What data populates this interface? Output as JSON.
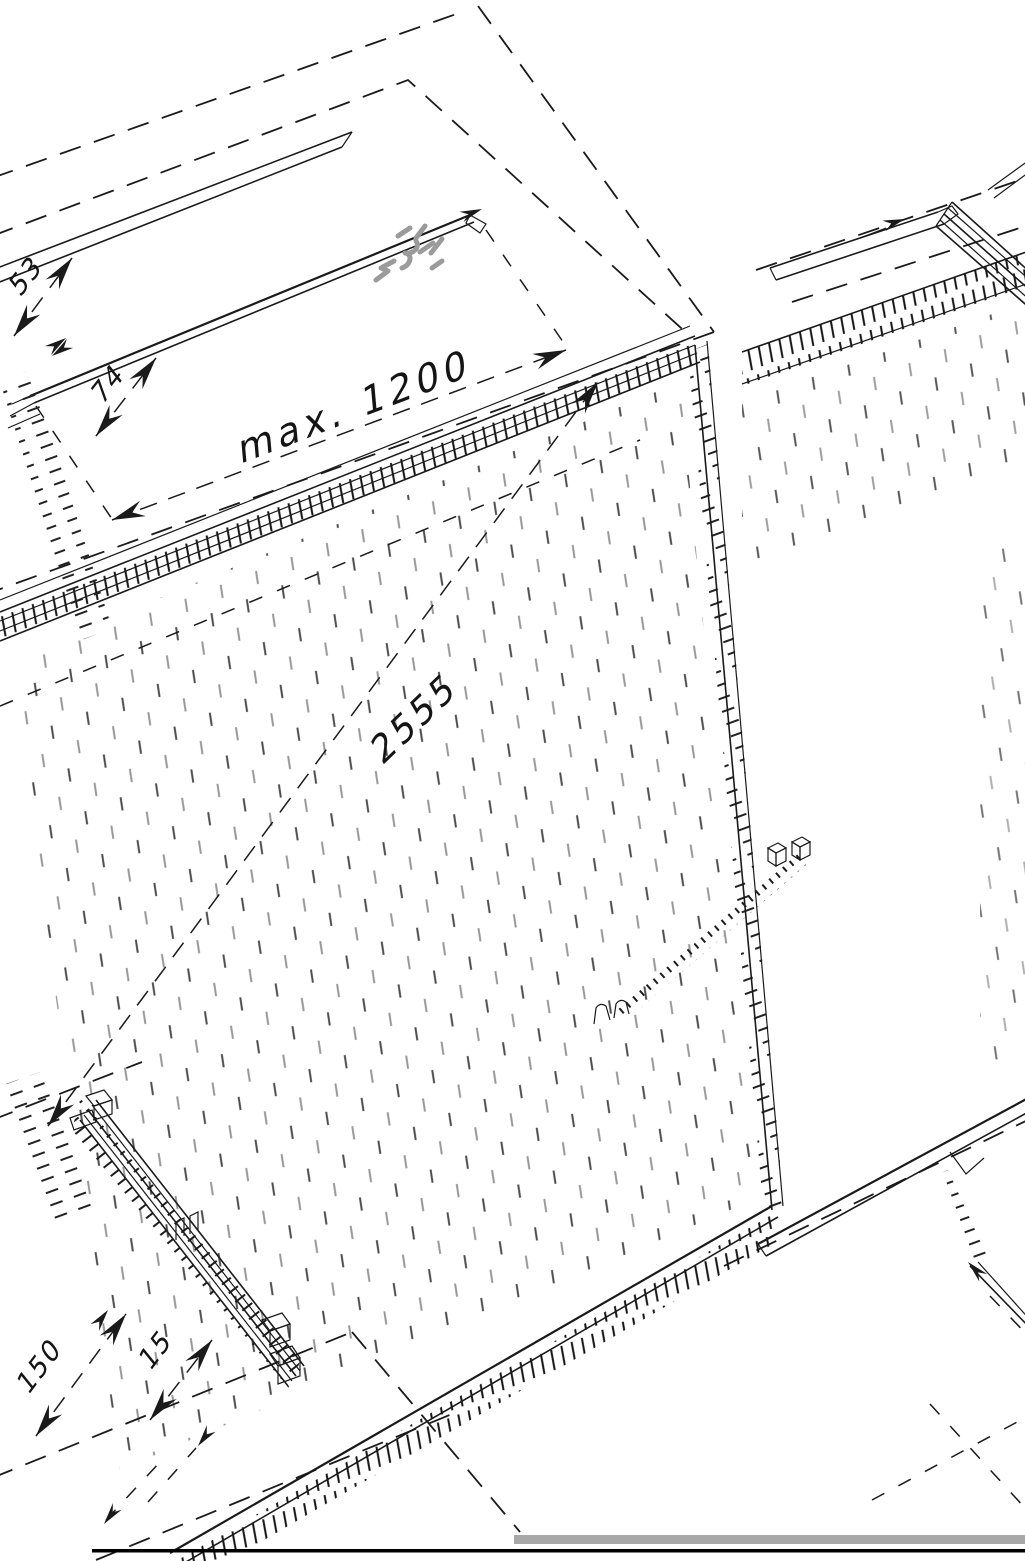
{
  "drawing": {
    "dimension_labels": {
      "max_width": "max. 1200",
      "panel_height": "2555",
      "top_gap": "53",
      "top_inner": "74",
      "floor_overall": "150",
      "floor_edge": "15"
    },
    "colors": {
      "line_black": "#1a1a1a",
      "annotation_gray": "#9b9b9b",
      "dot_gray": "#8d8d8d",
      "footer_bar_gray": "#a8a8a8",
      "footer_rule_black": "#000000",
      "background_white": "#ffffff"
    }
  }
}
